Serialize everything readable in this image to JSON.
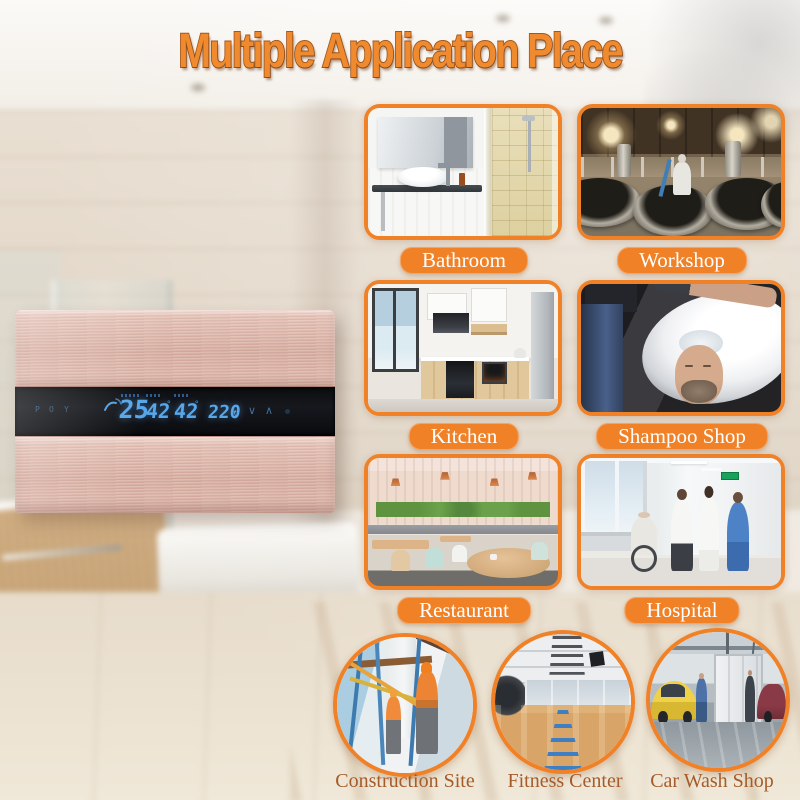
{
  "title": "Multiple Application Place",
  "heater": {
    "display": {
      "touch_icons": [
        "P",
        "O",
        "Y"
      ],
      "value_1": "25",
      "value_2": "42",
      "set_temp": "42",
      "degree": "°",
      "voltage": "220",
      "voltage_unit": "v",
      "down_arrow": "∨",
      "up_arrow": "∧"
    }
  },
  "tiles": [
    {
      "id": "bathroom",
      "label": "Bathroom"
    },
    {
      "id": "workshop",
      "label": "Workshop"
    },
    {
      "id": "kitchen",
      "label": "Kitchen"
    },
    {
      "id": "shampoo_shop",
      "label": "Shampoo Shop"
    },
    {
      "id": "restaurant",
      "label": "Restaurant"
    },
    {
      "id": "hospital",
      "label": "Hospital"
    }
  ],
  "round_tiles": [
    {
      "id": "construction_site",
      "label": "Construction Site"
    },
    {
      "id": "fitness_center",
      "label": "Fitness Center"
    },
    {
      "id": "car_wash_shop",
      "label": "Car Wash Shop"
    }
  ],
  "colors": {
    "accent_orange": "#F08127",
    "title_fill": "#EF8A2F",
    "title_outline": "#A4571C",
    "badge_text": "#FFFFFF",
    "round_label_text": "#A55C2A",
    "led_blue": "#58A7E8",
    "device_body": "#DCB3A6",
    "display_background": "#0C0D10"
  }
}
